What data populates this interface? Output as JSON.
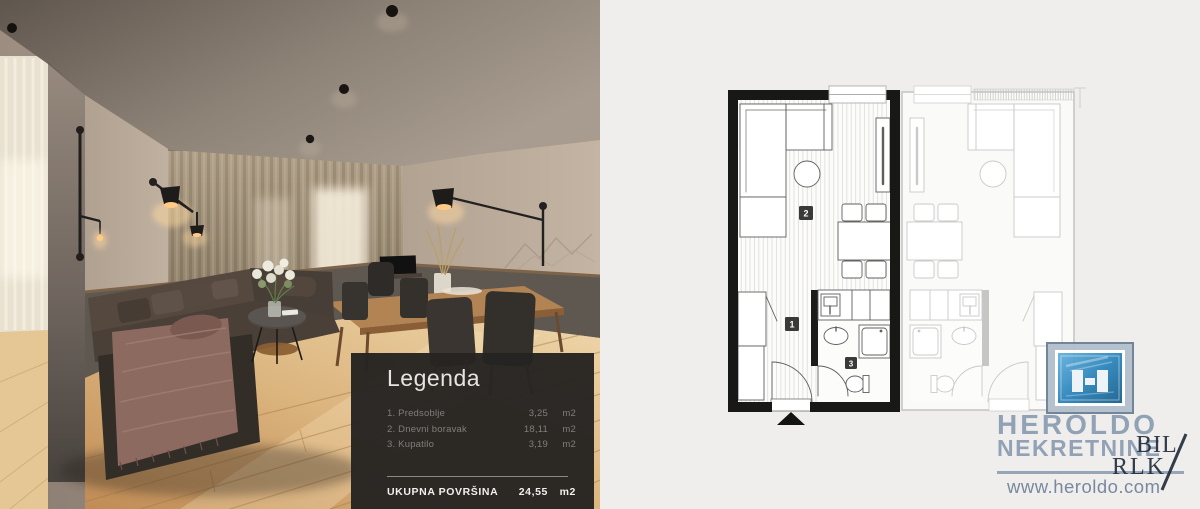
{
  "legend": {
    "title": "Legenda",
    "items": [
      {
        "num": "1.",
        "label": "Predsoblje",
        "value": "3,25",
        "unit": "m2"
      },
      {
        "num": "2.",
        "label": "Dnevni boravak",
        "value": "18,11",
        "unit": "m2"
      },
      {
        "num": "3.",
        "label": "Kupatilo",
        "value": "3,19",
        "unit": "m2"
      }
    ],
    "total_label": "UKUPNA POVRŠINA",
    "total_value": "24,55",
    "total_unit": "m2"
  },
  "floorplan": {
    "label_hallway": "1",
    "label_living": "2",
    "label_bathroom": "3"
  },
  "branding": {
    "name": "HEROLDO",
    "subtitle": "NEKRETNINE",
    "website": "www.heroldo.com",
    "watermark_line1": "BIL",
    "watermark_line2": "RLK"
  },
  "colors": {
    "brand_steel_blue": "#8c9db2",
    "icon_blue": "#2e86bd",
    "legend_bg": "#262422",
    "plan_wall": "#181816",
    "wood_floor": "#cf9d63"
  }
}
